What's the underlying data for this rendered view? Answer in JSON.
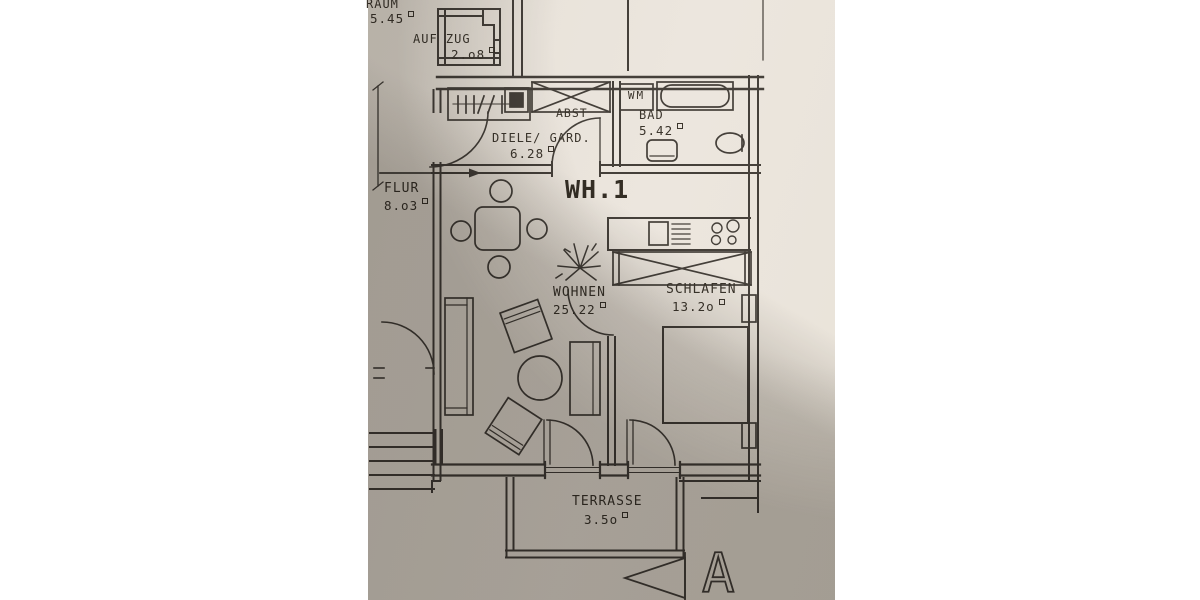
{
  "photo": {
    "paper_color": "#ebe5dc",
    "ink_color": "#45403a"
  },
  "rooms": {
    "raum": {
      "label": "RAUM",
      "area": "5.45"
    },
    "aufzug": {
      "label": "AUF ZUG",
      "area": "2.o8"
    },
    "abst": {
      "label": "ABST"
    },
    "wm": {
      "label": "WM"
    },
    "bad": {
      "label": "BAD",
      "area": "5.42"
    },
    "diele": {
      "label": "DIELE/ GARD.",
      "area": "6.28"
    },
    "flur": {
      "label": "FLUR",
      "area": "8.o3"
    },
    "wh1": {
      "label": "WH.1"
    },
    "wohnen": {
      "label": "WOHNEN",
      "area": "25.22"
    },
    "schlafen": {
      "label": "SCHLAFEN",
      "area": "13.2o"
    },
    "terrasse": {
      "label": "TERRASSE",
      "area": "3.5o"
    }
  },
  "section_marker": {
    "label": "A"
  }
}
